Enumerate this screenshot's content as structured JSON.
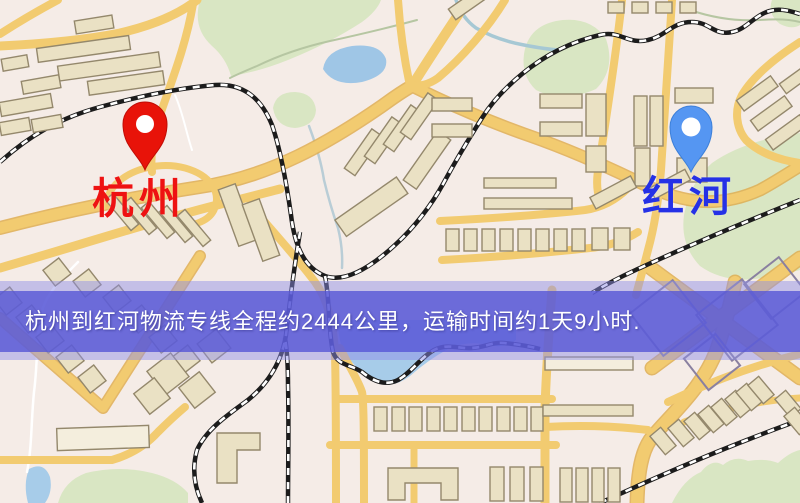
{
  "markers": {
    "origin": {
      "name": "杭州",
      "pin_color": "#e81309",
      "label_color": "#ee1212",
      "icon": "location-pin-icon"
    },
    "destination": {
      "name": "红河",
      "pin_color": "#5596f2",
      "label_color": "#2531e6",
      "icon": "location-pin-icon"
    }
  },
  "banner": {
    "text": "杭州到红河物流专线全程约2444公里，运输时间约1天9小时.",
    "distance_km": "2444",
    "duration": "1天9小时",
    "background_color": "#5656d6",
    "text_color": "#ffffff"
  },
  "map_colors": {
    "background": "#f6efe9",
    "road": "#f2cb70",
    "road_casing": "#dfae52",
    "water": "#a7cce9",
    "park": "#d9e6c3",
    "building": "#eae1c4",
    "railway": "#1a1a1a"
  }
}
